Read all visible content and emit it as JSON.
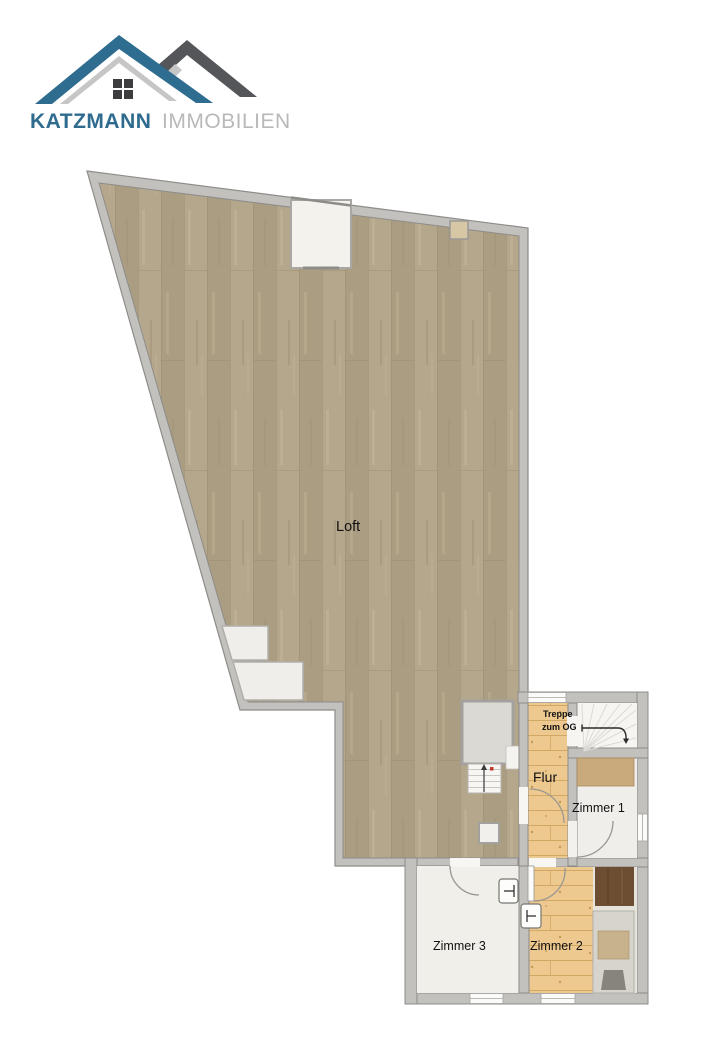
{
  "logo": {
    "brand": "KATZMANN",
    "suffix": "IMMOBILIEN",
    "brand_color": "#2e6b8f",
    "suffix_color": "#b9b9b9",
    "roof_blue": "#2e6d90",
    "roof_gray": "#54565a",
    "roof_accent": "#c6c6c6",
    "window_color": "#3d3d3f"
  },
  "floorplan": {
    "labels": {
      "loft": "Loft",
      "flur": "Flur",
      "treppe_line1": "Treppe",
      "treppe_line2": "zum OG",
      "zimmer1": "Zimmer 1",
      "zimmer2": "Zimmer 2",
      "zimmer3": "Zimmer 3"
    },
    "colors": {
      "wall_fill": "#c2c1be",
      "wall_line": "#8d8c89",
      "loft_wood": "#b1a288",
      "pine_wood": "#edc98f",
      "cream_floor": "#f0efea",
      "stairs_white": "#f6f5f2",
      "landing_gray": "#dbd9d4",
      "sideboard_tan": "#c8aa7d",
      "wardrobe_brown": "#6e4e33",
      "bed_frame": "#d7d4cd",
      "mattress_tan": "#c8b28c",
      "marker_red": "#c0392b"
    }
  }
}
